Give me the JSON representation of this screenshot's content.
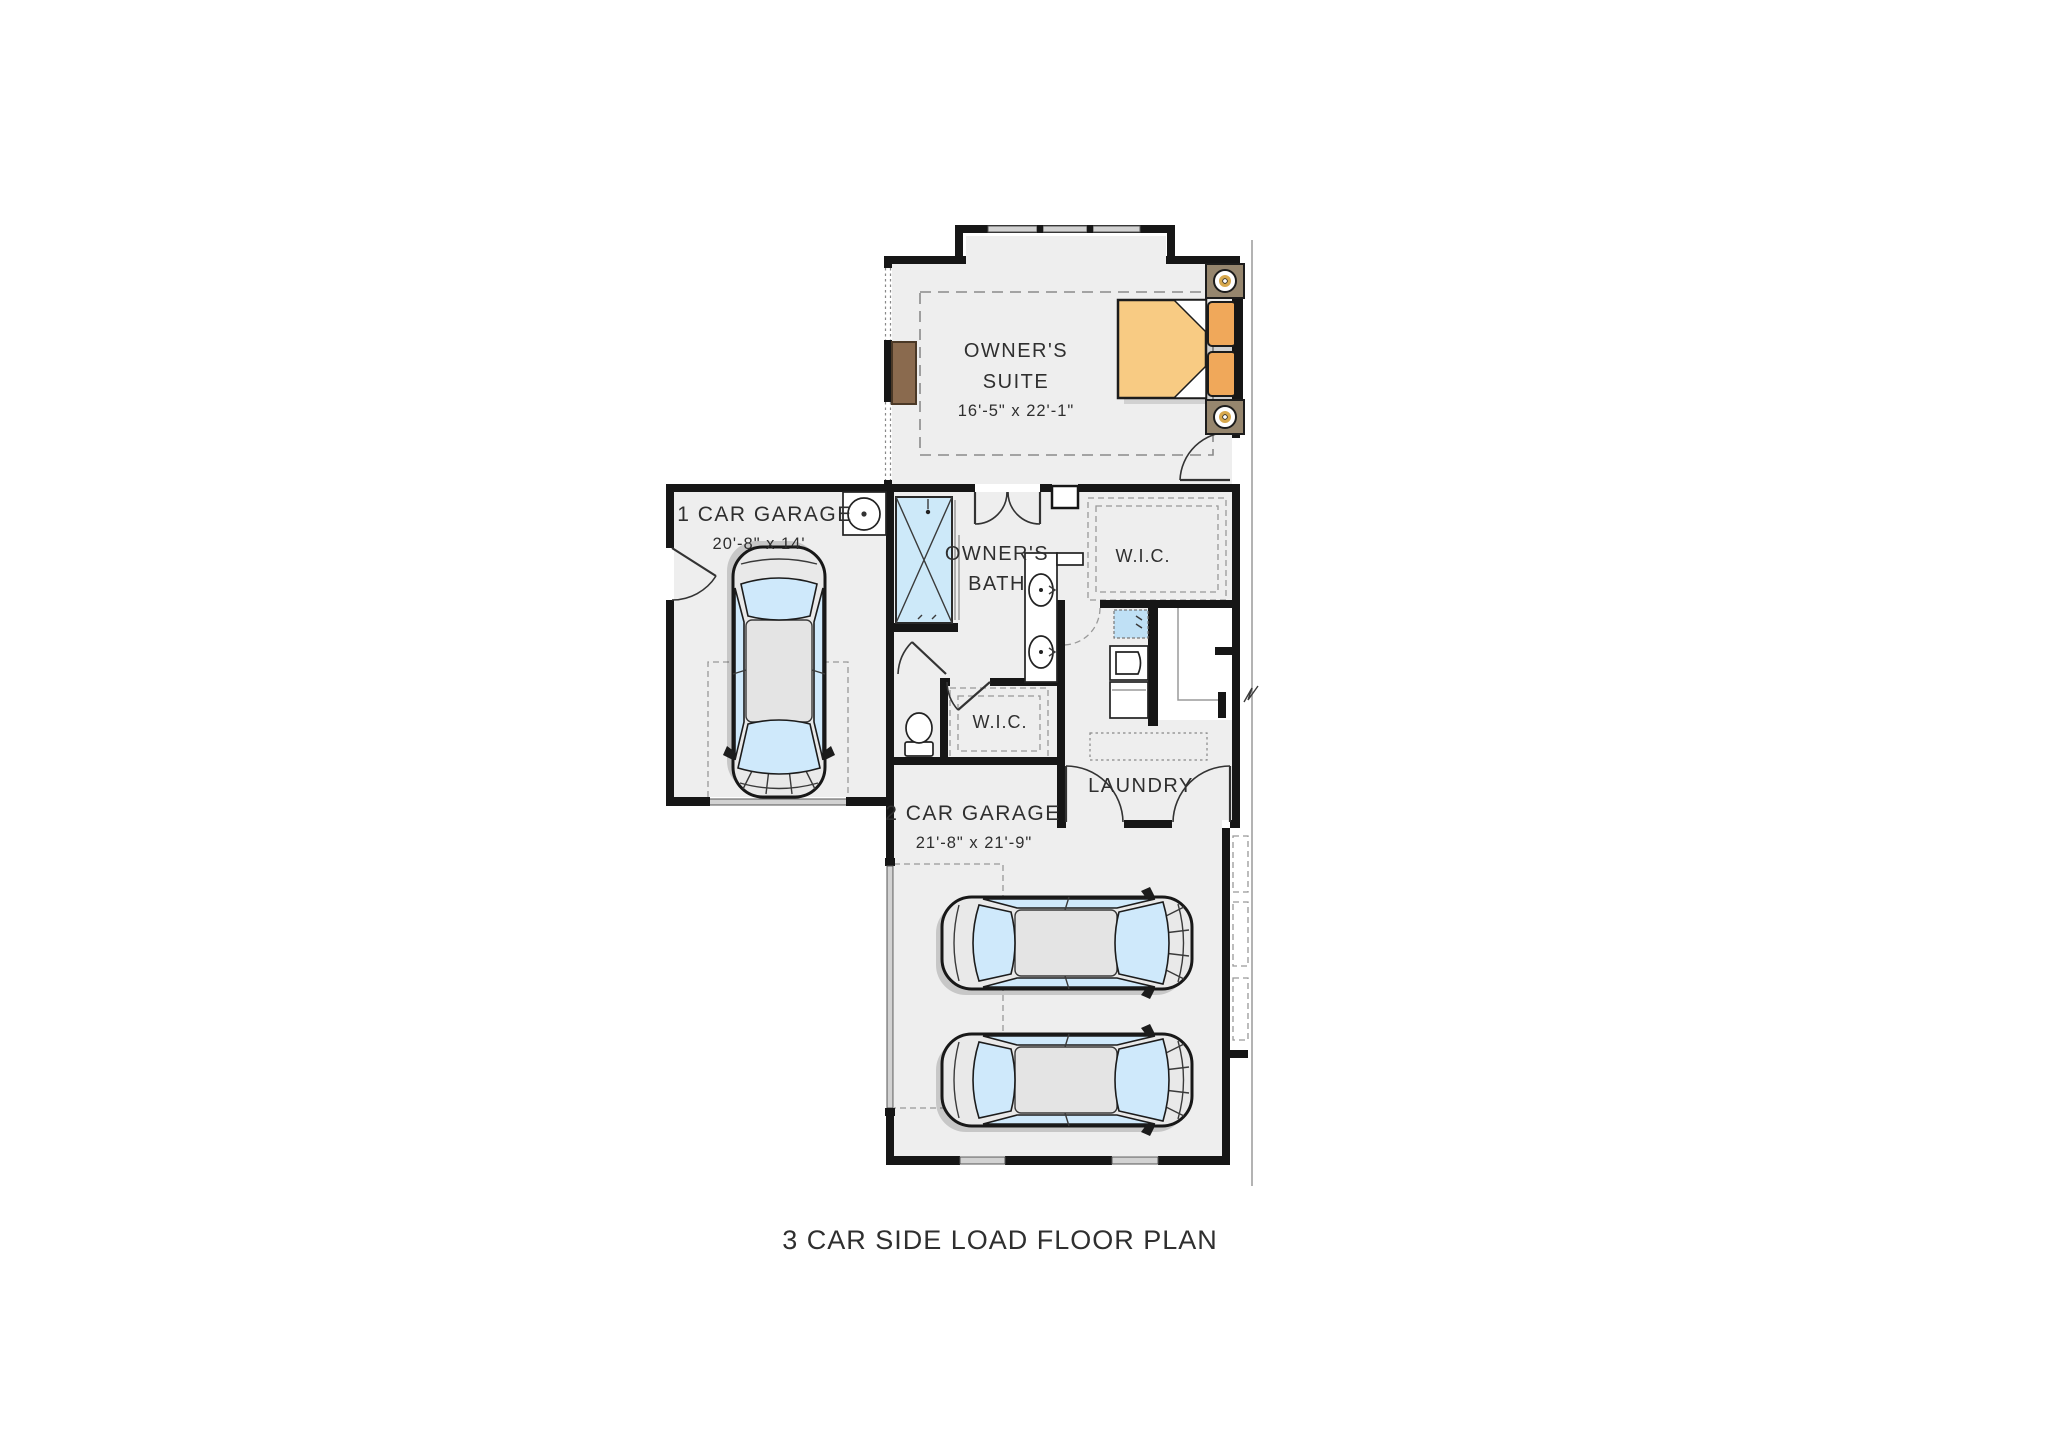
{
  "plan": {
    "title": "3 CAR SIDE LOAD FLOOR PLAN",
    "rooms": {
      "owners_suite": {
        "name_line1": "OWNER'S",
        "name_line2": "SUITE",
        "dims": "16'-5\" x 22'-1\""
      },
      "owners_bath": {
        "name_line1": "OWNER'S",
        "name_line2": "BATH"
      },
      "wic_upper": {
        "name": "W.I.C."
      },
      "wic_lower": {
        "name": "W.I.C."
      },
      "laundry": {
        "name": "LAUNDRY"
      },
      "garage_1car": {
        "name": "1 CAR GARAGE",
        "dims": "20'-8\" x 14'"
      },
      "garage_2car": {
        "name": "2 CAR GARAGE",
        "dims": "21'-8\" x 21'-9\""
      }
    },
    "colors": {
      "wall": "#161616",
      "floor": "#eeeeee",
      "text": "#2f2f2f",
      "glass": "#cfe9fb",
      "shower": "#cde9f9",
      "windowbar": "#d2d2d2",
      "bed": "#f8cb83",
      "pillow": "#f0a85a",
      "wood": "#8a6a4e",
      "stand": "#96866e",
      "gold": "#d8a94e",
      "dash": "#8a8a8a",
      "carbody": "#e9e9e9"
    }
  }
}
